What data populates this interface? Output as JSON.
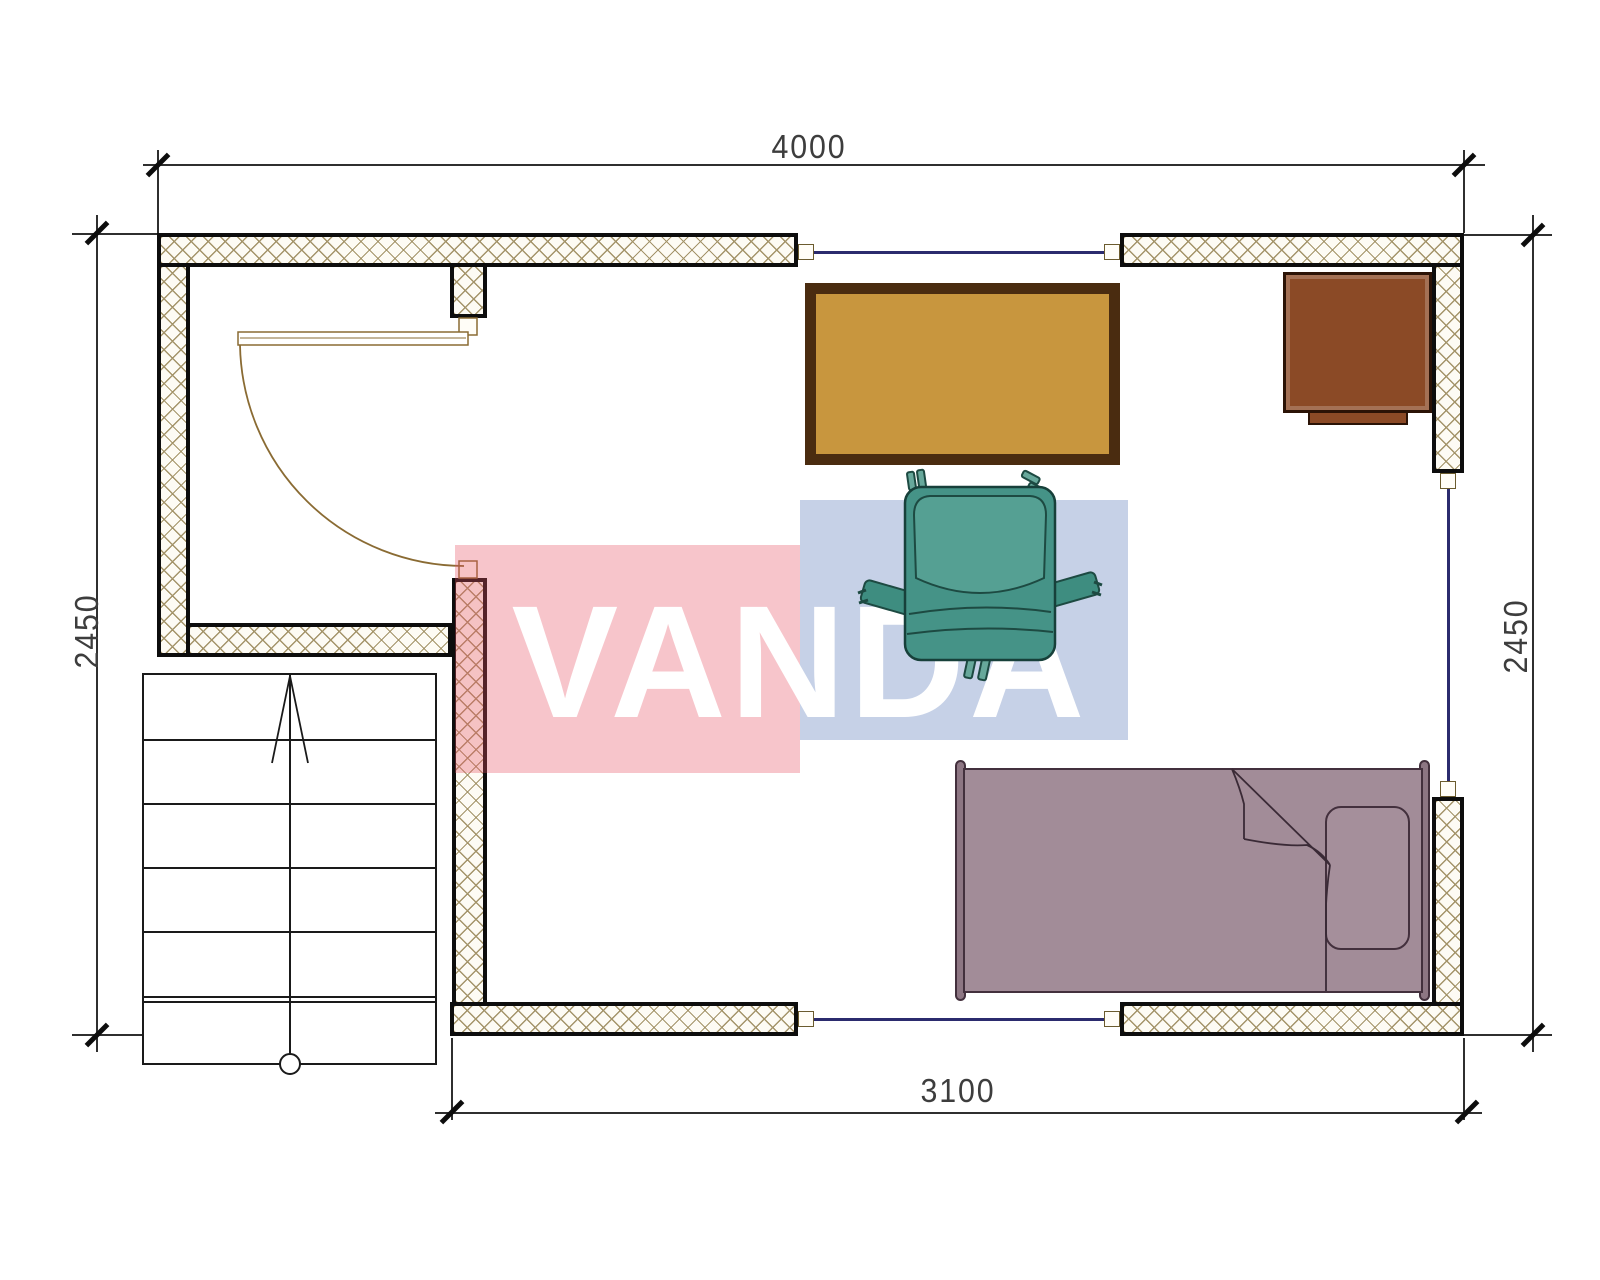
{
  "drawing": {
    "title": "floor-plan",
    "dims": {
      "top": "4000",
      "left": "2450",
      "right": "2450",
      "bottom": "3100"
    },
    "watermark": {
      "text": "VANDA",
      "red_overlay": "#e85062",
      "blue_overlay": "#7891c6",
      "text_color": "#ffffff"
    },
    "palette": {
      "wall_fill": "#fdfbf4",
      "wall_hatch_line": "#a4946a",
      "wall_outline": "#0d0d0d",
      "window_line": "#2b2b6e",
      "door_line": "#8a6b33",
      "table_fill": "#c8963e",
      "table_border": "#4a2c10",
      "cabinet_fill": "#8b4a26",
      "chair_fill": "#459387",
      "chair_outline": "#1d4a42",
      "bed_fill": "#a28c98",
      "bed_outline": "#43303d",
      "dim_text_color": "#3d3d3d"
    },
    "furniture": [
      {
        "name": "table-with-cross-base"
      },
      {
        "name": "office-armchair"
      },
      {
        "name": "cabinet"
      },
      {
        "name": "single-bed"
      },
      {
        "name": "staircase"
      }
    ]
  }
}
